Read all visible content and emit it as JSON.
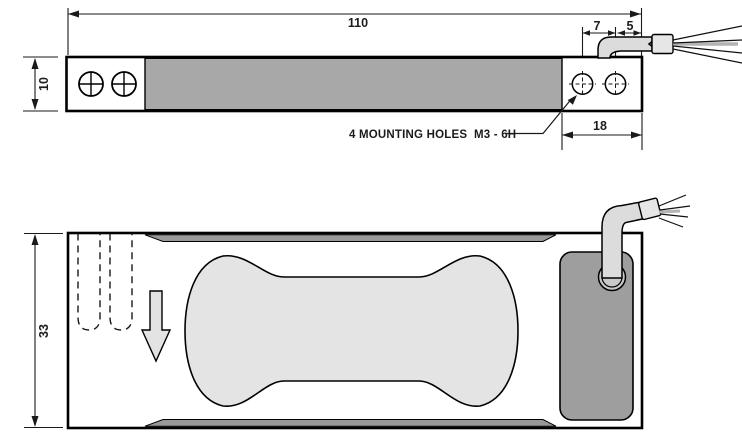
{
  "drawing": {
    "note": "4 MOUNTING HOLES  M3 - 6H",
    "dims": {
      "length": "110",
      "thickness": "10",
      "hole_pitch": "7",
      "cable_end_offset": "5",
      "mount_block_length": "18",
      "width": "33"
    },
    "colors": {
      "body_gray": "#a8a8a8",
      "edge_strip_gray": "#999999",
      "pocket_light_gray": "#e4e4e4",
      "gland_dark_gray": "#9e9e9e",
      "cable_light_gray": "#dcdcdc",
      "ferrule_gray": "#e6e6e6",
      "arrow_light_gray": "#e3e3e3",
      "grommet_gray": "#c9c9c9",
      "line": "#000000",
      "background": "#ffffff"
    }
  }
}
